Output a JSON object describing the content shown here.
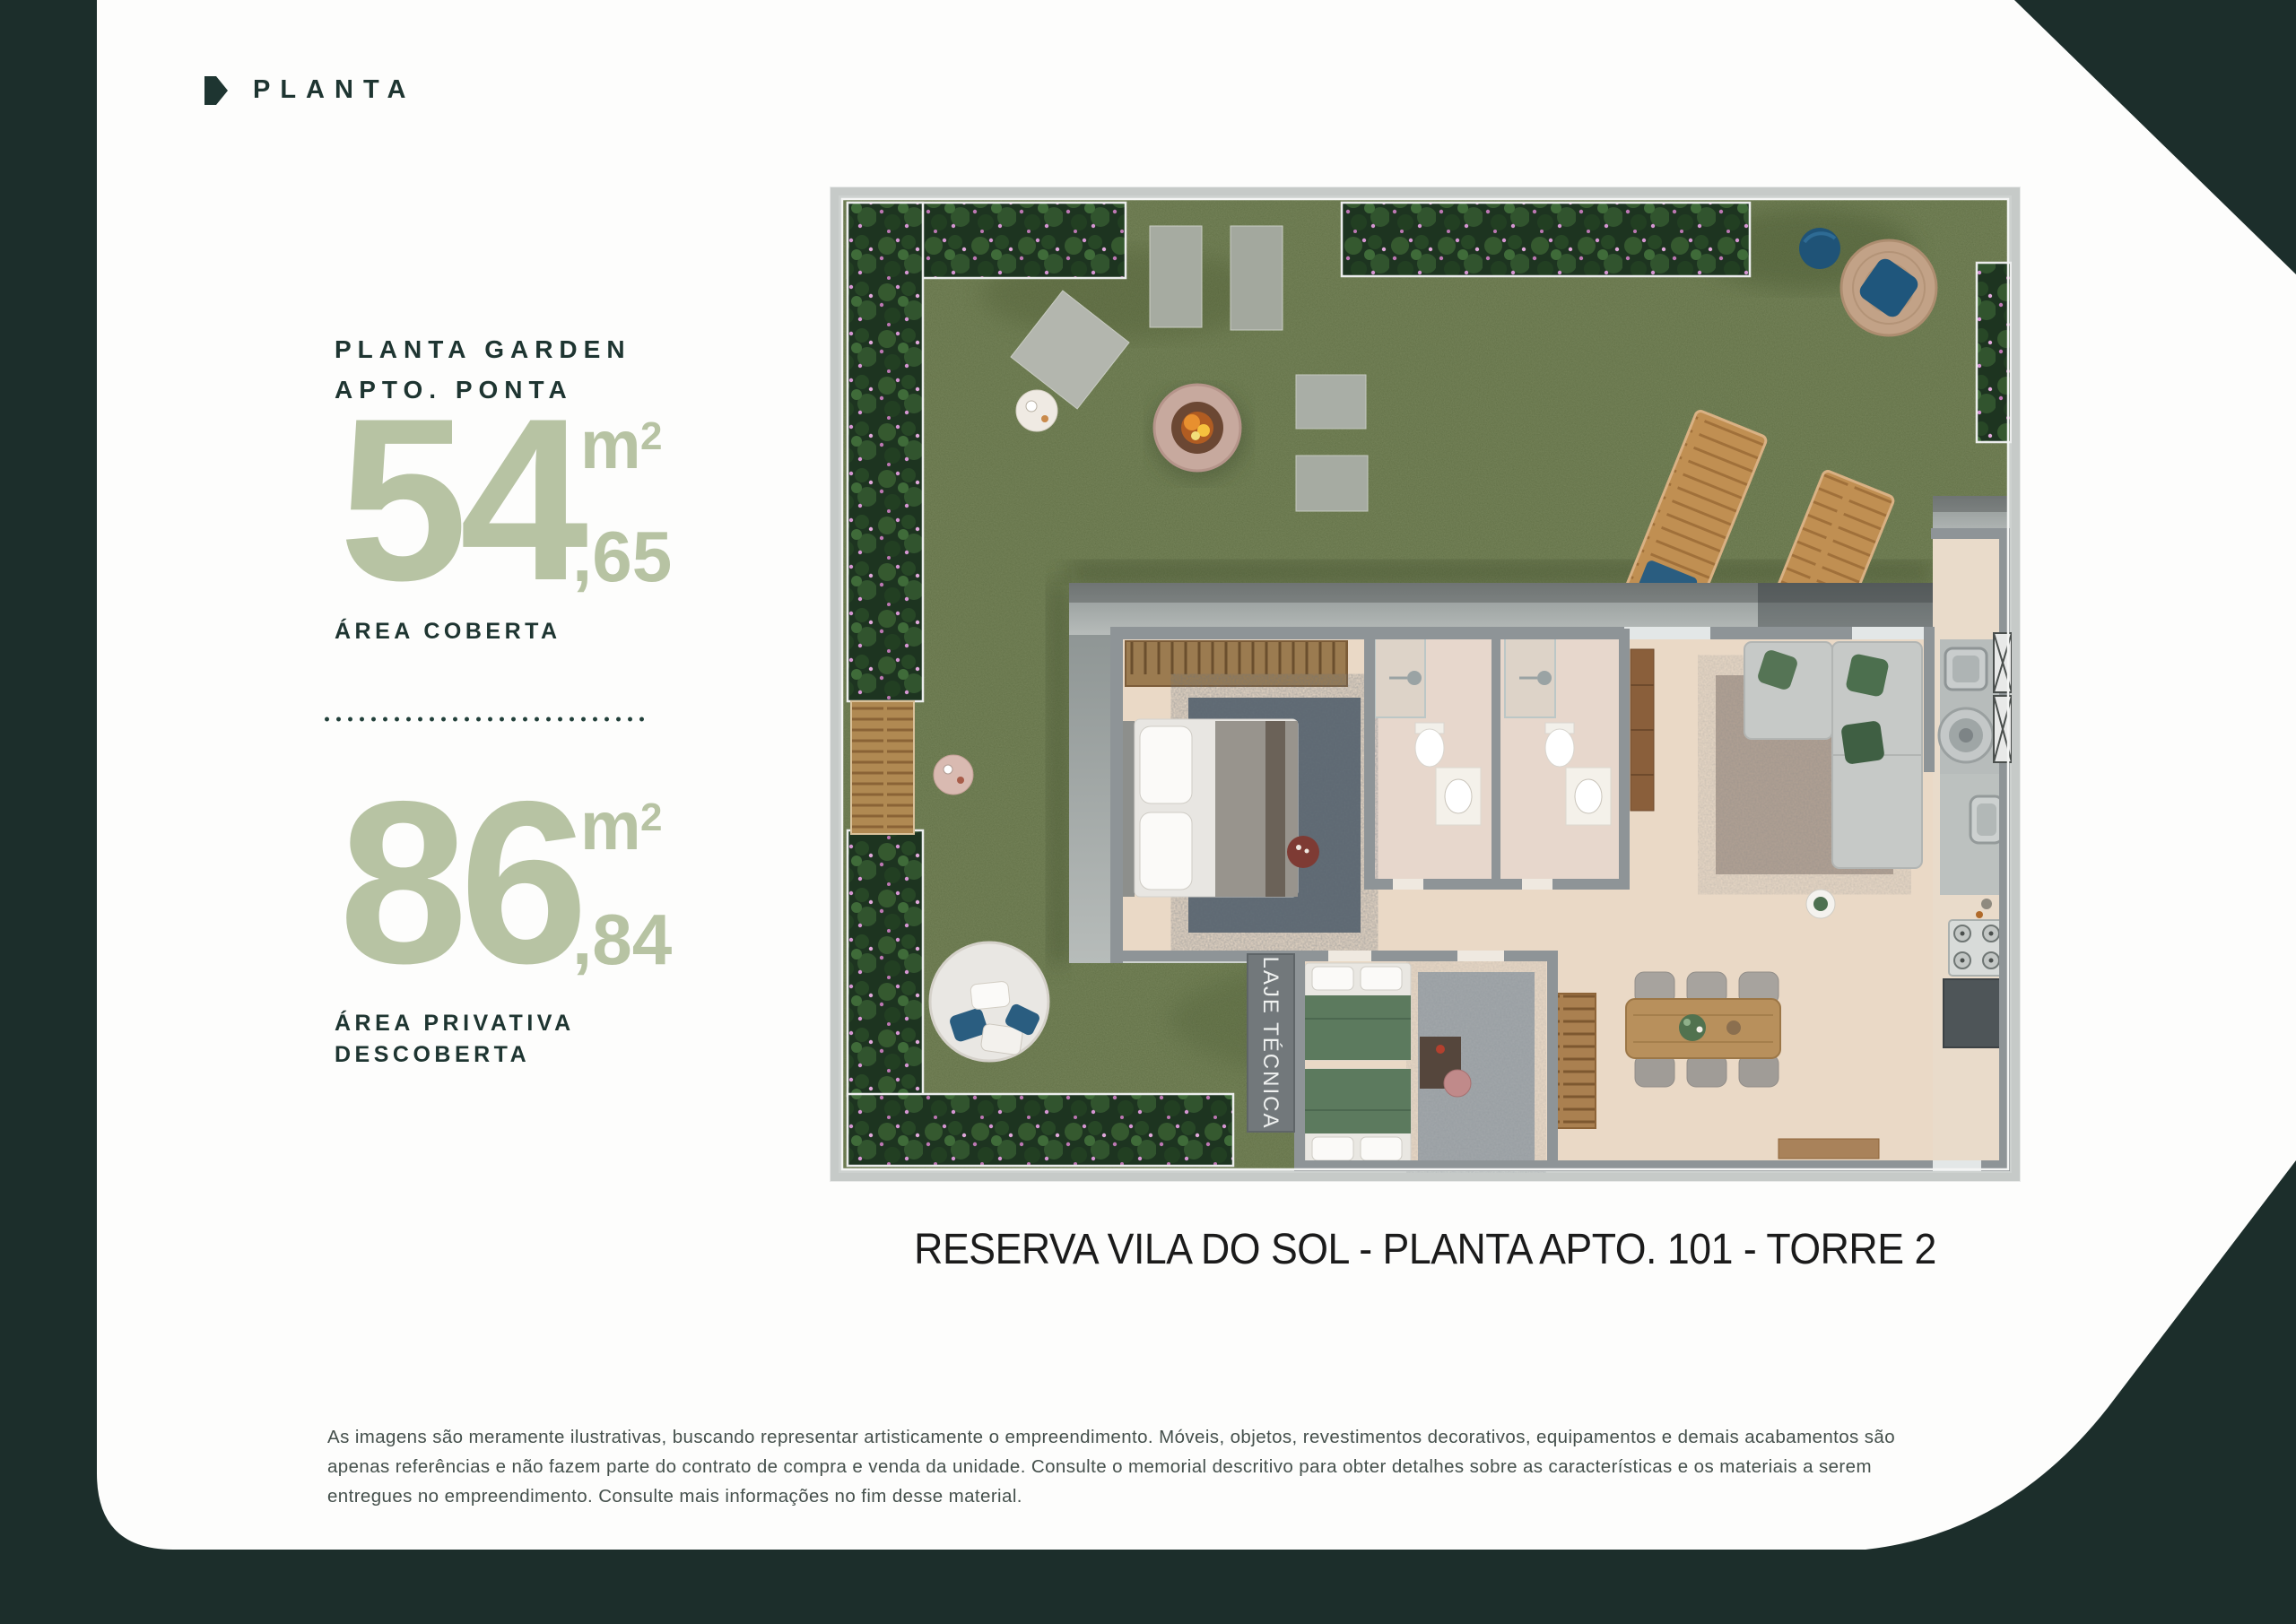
{
  "colors": {
    "background": "#1c2e2b",
    "card": "#fdfdfc",
    "accent_sage": "#b7c3a3",
    "heading_dark": "#1e3531",
    "caption_text": "#1b1b1b",
    "disclaimer_text": "#45504c"
  },
  "header": {
    "title": "PLANTA"
  },
  "stats": {
    "title_line1": "PLANTA GARDEN",
    "title_line2": "APTO. PONTA",
    "covered": {
      "value": "54",
      "unit": "m",
      "unit_sup": "2",
      "decimal": ",65",
      "label": "ÁREA COBERTA"
    },
    "private": {
      "value": "86",
      "unit": "m",
      "unit_sup": "2",
      "decimal": ",84",
      "label_line1": "ÁREA PRIVATIVA",
      "label_line2": "DESCOBERTA"
    }
  },
  "floorplan": {
    "technical_slab_label": "LAJE TÉCNICA",
    "caption": "RESERVA VILA DO SOL - PLANTA APTO. 101 - TORRE 2"
  },
  "disclaimer": "As imagens são meramente ilustrativas, buscando representar artisticamente o empreendimento. Móveis, objetos, revestimentos decorativos, equipamentos e demais acabamentos são apenas referências e não fazem parte do contrato de compra e venda da unidade. Consulte o memorial descritivo para obter detalhes sobre as características e os materiais a serem entregues no empreendimento. Consulte mais informações no fim desse material."
}
